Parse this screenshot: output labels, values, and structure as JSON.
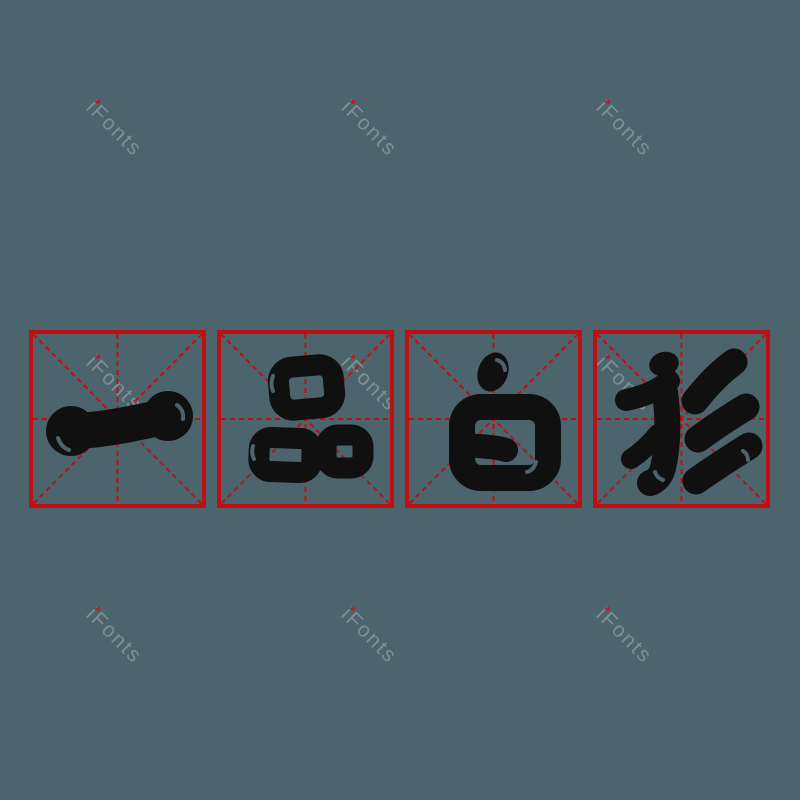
{
  "phrase": {
    "text": "一品白衫",
    "characters": [
      "一",
      "品",
      "白",
      "衫"
    ]
  },
  "watermark": {
    "text": "iFonts"
  },
  "colors": {
    "background": "#4c646b",
    "grid_red": "#c00f14",
    "ink": "#101010",
    "watermark": "rgba(255,255,255,0.28)",
    "watermark_dot": "#e60012"
  }
}
